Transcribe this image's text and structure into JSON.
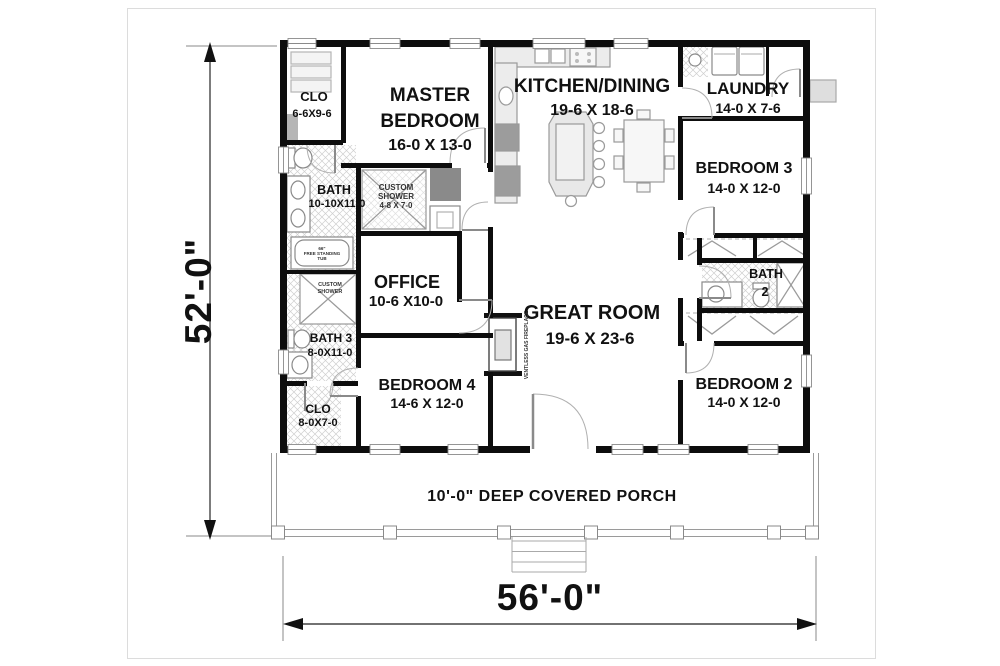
{
  "dimensions": {
    "height": "52'-0\"",
    "width": "56'-0\""
  },
  "porch": {
    "label": "10'-0\" DEEP COVERED PORCH"
  },
  "rooms": {
    "clo_master": {
      "name": "CLO",
      "dims": "6-6X9-6"
    },
    "master_bedroom": {
      "line1": "MASTER",
      "line2": "BEDROOM",
      "dims": "16-0 X 13-0"
    },
    "kitchen_dining": {
      "name": "KITCHEN/DINING",
      "dims": "19-6 X 18-6"
    },
    "laundry": {
      "name": "LAUNDRY",
      "dims": "14-0 X 7-6"
    },
    "bedroom3": {
      "name": "BEDROOM 3",
      "dims": "14-0 X 12-0"
    },
    "master_bath": {
      "name": "BATH",
      "dims": "10-10X11-0"
    },
    "custom_shower": {
      "line1": "CUSTOM",
      "line2": "SHOWER",
      "dims": "4-8 X 7-0"
    },
    "office": {
      "name": "OFFICE",
      "dims": "10-6 X10-0"
    },
    "great_room": {
      "name": "GREAT ROOM",
      "dims": "19-6 X 23-6"
    },
    "bath2": {
      "name": "BATH",
      "number": "2"
    },
    "bath3": {
      "name": "BATH 3",
      "dims": "8-0X11-0"
    },
    "clo_hall": {
      "name": "CLO",
      "dims": "8-0X7-0"
    },
    "bedroom4": {
      "name": "BEDROOM 4",
      "dims": "14-6 X 12-0"
    },
    "bedroom2": {
      "name": "BEDROOM 2",
      "dims": "14-0 X 12-0"
    }
  },
  "annotations": {
    "fireplace": "VENTLESS GAS FIREPLACE",
    "tub_line1": "66\"",
    "tub_line2": "FREE STANDING",
    "tub_line3": "TUB",
    "bath3_shower_line1": "CUSTOM",
    "bath3_shower_line2": "SHOWER"
  },
  "colors": {
    "wall": "#0d0d0d",
    "text": "#111111",
    "fixture": "#8a8a8a"
  }
}
